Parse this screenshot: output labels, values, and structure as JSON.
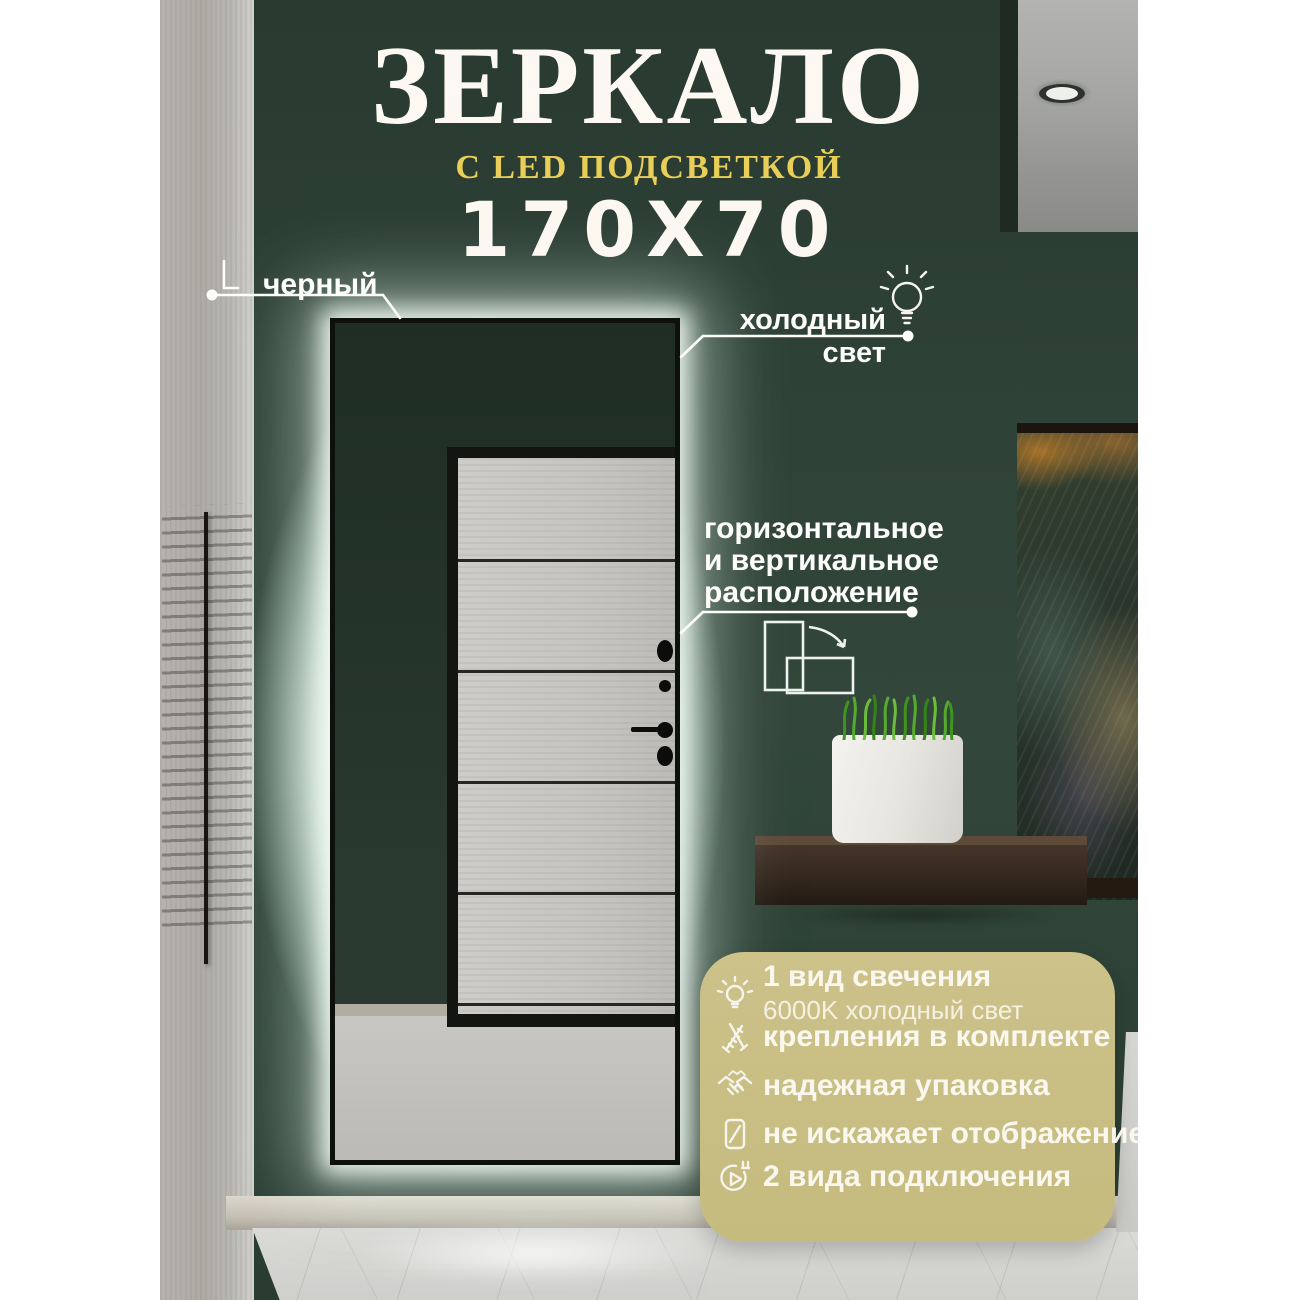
{
  "title": {
    "main": "ЗЕРКАЛО",
    "subtitle": "С LED ПОДСВЕТКОЙ",
    "size": "170X70"
  },
  "callouts": {
    "frame_color": {
      "label": "черный"
    },
    "light": {
      "label": "холодный свет",
      "icon": "lightbulb-icon"
    },
    "orientation": {
      "lines": [
        "горизонтальное",
        "и вертикальное",
        "расположение"
      ],
      "icon": "rotate-icon"
    }
  },
  "features": {
    "items": [
      {
        "icon": "lightbulb-icon",
        "label": "1 вид свечения",
        "sublabel": "6000K холодный свет"
      },
      {
        "icon": "screws-icon",
        "label": "крепления в комплекте"
      },
      {
        "icon": "handshake-icon",
        "label": "надежная упаковка"
      },
      {
        "icon": "mirror-icon",
        "label": "не искажает отображение"
      },
      {
        "icon": "plug-icon",
        "label": "2 вида подключения"
      }
    ]
  },
  "colors": {
    "accent_yellow": "#e9cf57",
    "feature_box": "#c8be83",
    "wall_green": "#31443a",
    "led_glow": "#eaf7ef",
    "mirror_frame": "#0e100e"
  }
}
